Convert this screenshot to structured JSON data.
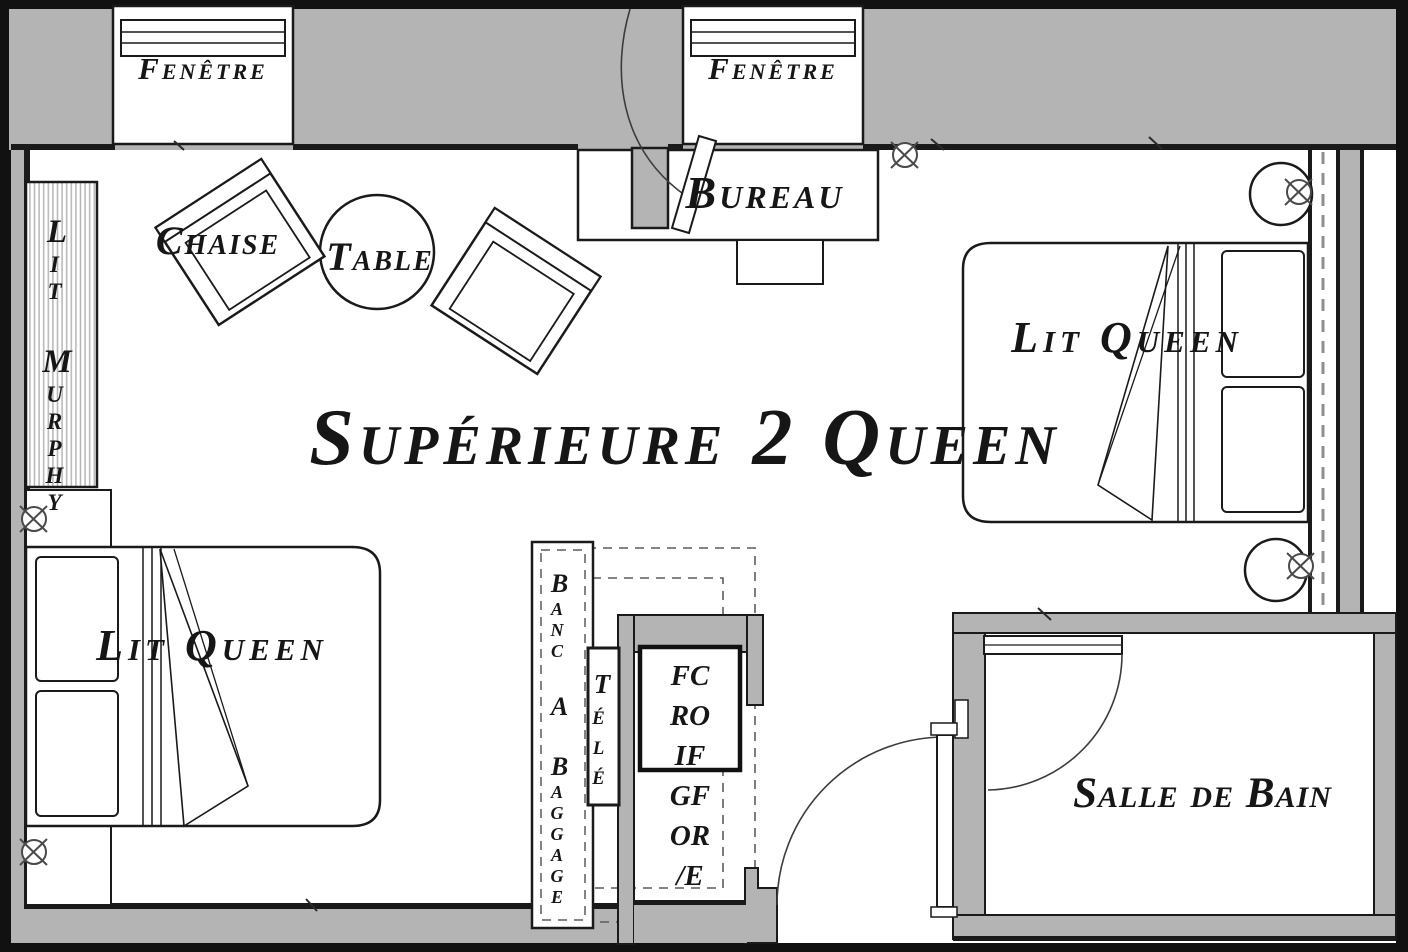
{
  "title": "Supérieure 2 Queen",
  "windows": {
    "left_label": "Fenêtre",
    "right_label": "Fenêtre"
  },
  "rooms": {
    "bathroom_label": "Salle de Bain"
  },
  "furniture": {
    "desk_label": "Bureau",
    "chair_label": "Chaise",
    "table_label": "Table",
    "murphy_bed_label": "Lit Murphy",
    "bed_left_label": "Lit Queen",
    "bed_right_label": "Lit Queen",
    "luggage_bench_label": "Banc A Baggage",
    "tv_label": "Télé",
    "fridge_safe_lines": [
      "FC",
      "RO",
      "IF",
      "GF",
      "OR",
      "/E"
    ]
  },
  "colors": {
    "wall_fill": "#b4b4b4",
    "line": "#1a1a1a",
    "floor": "#ffffff",
    "dashed_line": "#8f8f8f"
  }
}
